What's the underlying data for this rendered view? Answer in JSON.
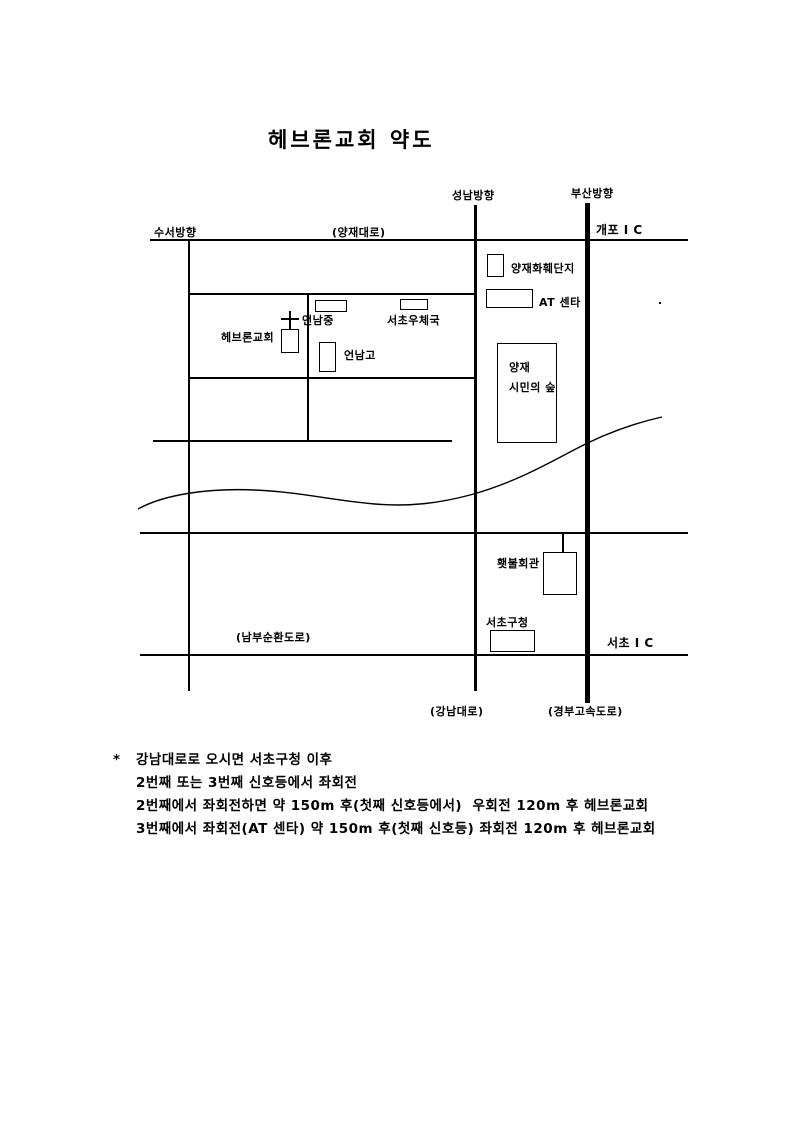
{
  "title": "헤브론교회 약도",
  "map": {
    "directions": {
      "suseo": "수서방향",
      "seongnam": "성남방향",
      "busan": "부산방향"
    },
    "roads": {
      "yangjae_daero": "(양재대로)",
      "nambu_beltway": "(남부순환도로)",
      "gangnam_daero": "(강남대로)",
      "gyeongbu_expressway": "(경부고속도로)"
    },
    "interchanges": {
      "gaepo": "개포 I C",
      "seocho": "서초 I C"
    },
    "places": {
      "hebron_church": "헤브론교회",
      "eonnam_middle_school": "언남중",
      "seocho_post_office": "서초우체국",
      "eonnam_high_school": "언남고",
      "yangjae_flower_complex": "양재화훼단지",
      "at_center": "AT 센타",
      "citizens_forest_line1": "양재",
      "citizens_forest_line2": "시민의 숲",
      "torch_hall": "횃불회관",
      "seocho_gu_office": "서초구청"
    },
    "stray_dot": "."
  },
  "notes": {
    "bullet": "*",
    "lines": [
      "강남대로로 오시면 서초구청 이후",
      "2번째 또는 3번째 신호등에서 좌회전",
      "2번째에서 좌회전하면 약 150m 후(첫째 신호등에서)  우회전 120m 후 헤브론교회",
      "3번째에서 좌회전(AT 센타) 약 150m 후(첫째 신호등) 좌회전 120m 후 헤브론교회"
    ]
  },
  "colors": {
    "ink": "#000000",
    "paper": "#ffffff"
  }
}
